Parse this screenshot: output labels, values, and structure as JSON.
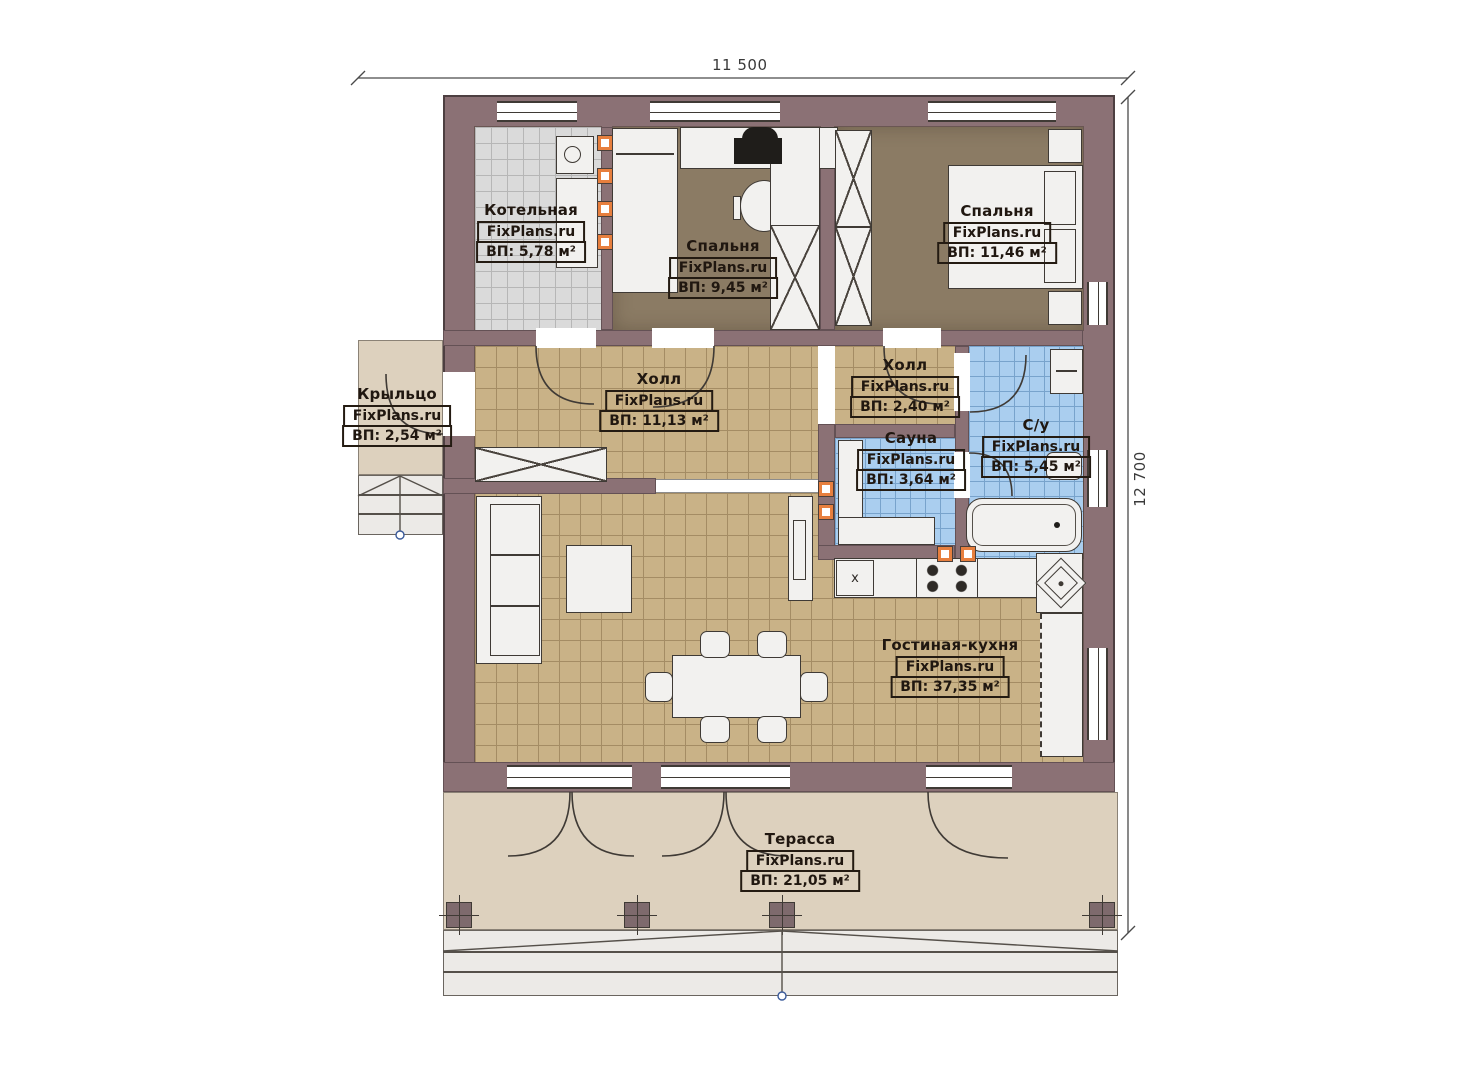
{
  "brand": "FixPlans.ru",
  "dimensions": {
    "width_label": "11 500",
    "height_label": "12 700"
  },
  "kitchen": {
    "marker": "x"
  },
  "rooms": {
    "boiler": {
      "name": "Котельная",
      "brand": "FixPlans.ru",
      "area": "ВП: 5,78 м²"
    },
    "bedroom1": {
      "name": "Спальня",
      "brand": "FixPlans.ru",
      "area": "ВП: 9,45 м²"
    },
    "bedroom2": {
      "name": "Спальня",
      "brand": "FixPlans.ru",
      "area": "ВП: 11,46 м²"
    },
    "porch": {
      "name": "Крыльцо",
      "brand": "FixPlans.ru",
      "area": "ВП: 2,54 м²"
    },
    "hall_main": {
      "name": "Холл",
      "brand": "FixPlans.ru",
      "area": "ВП: 11,13 м²"
    },
    "hall_small": {
      "name": "Холл",
      "brand": "FixPlans.ru",
      "area": "ВП: 2,40 м²"
    },
    "sauna": {
      "name": "Сауна",
      "brand": "FixPlans.ru",
      "area": "ВП: 3,64 м²"
    },
    "bathroom": {
      "name": "С/у",
      "brand": "FixPlans.ru",
      "area": "ВП: 5,45 м²"
    },
    "living": {
      "name": "Гостиная-кухня",
      "brand": "FixPlans.ru",
      "area": "ВП: 37,35 м²"
    },
    "terrace": {
      "name": "Терасса",
      "brand": "FixPlans.ru",
      "area": "ВП: 21,05 м²"
    }
  },
  "colors": {
    "wall": "#8b7175",
    "floor_tan": "#c9b287",
    "floor_blue": "#aaceef",
    "floor_gray": "#dadada",
    "floor_bedroom": "#8b7b64",
    "terrace": "#ddd1be",
    "marker_accent": "#e77f3e",
    "line": "#3f3a35"
  }
}
